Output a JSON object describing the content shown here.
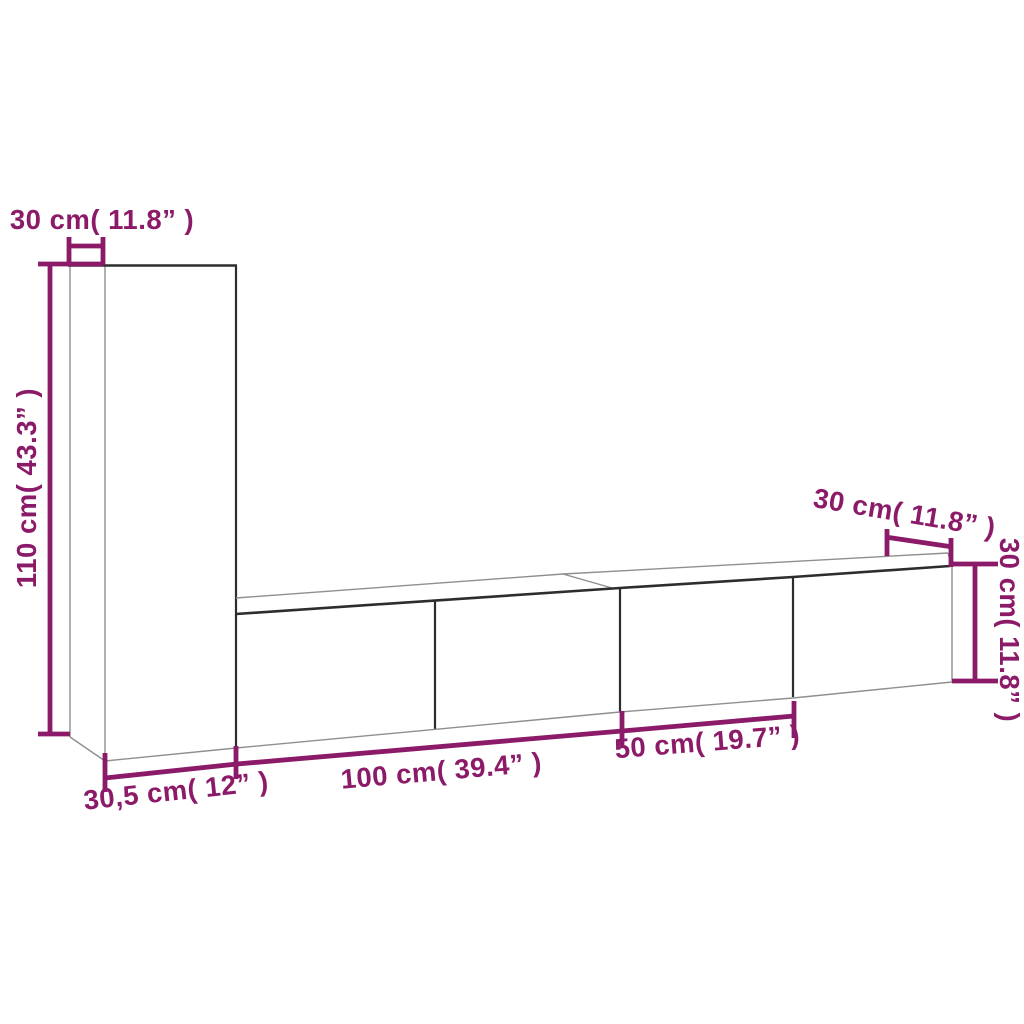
{
  "diagram": {
    "kind": "product-dimension-diagram",
    "subject": "wall-mounted-tv-cabinet-set",
    "background_color": "#ffffff",
    "accent_color": "#8b1a68",
    "edge_dark_color": "#2d2d2d",
    "edge_light_color": "#8f8f8f",
    "labels": {
      "tall_cabinet_depth": "30 cm( 11.8” )",
      "tall_cabinet_height": "110 cm( 43.3” )",
      "tall_cabinet_width": "30,5 cm( 12” )",
      "wide_cabinet_width": "100 cm( 39.4” )",
      "medium_cabinet_width": "50 cm( 19.7” )",
      "right_cabinet_depth": "30 cm( 11.8” )",
      "right_cabinet_height": "30 cm( 11.8” )"
    }
  }
}
